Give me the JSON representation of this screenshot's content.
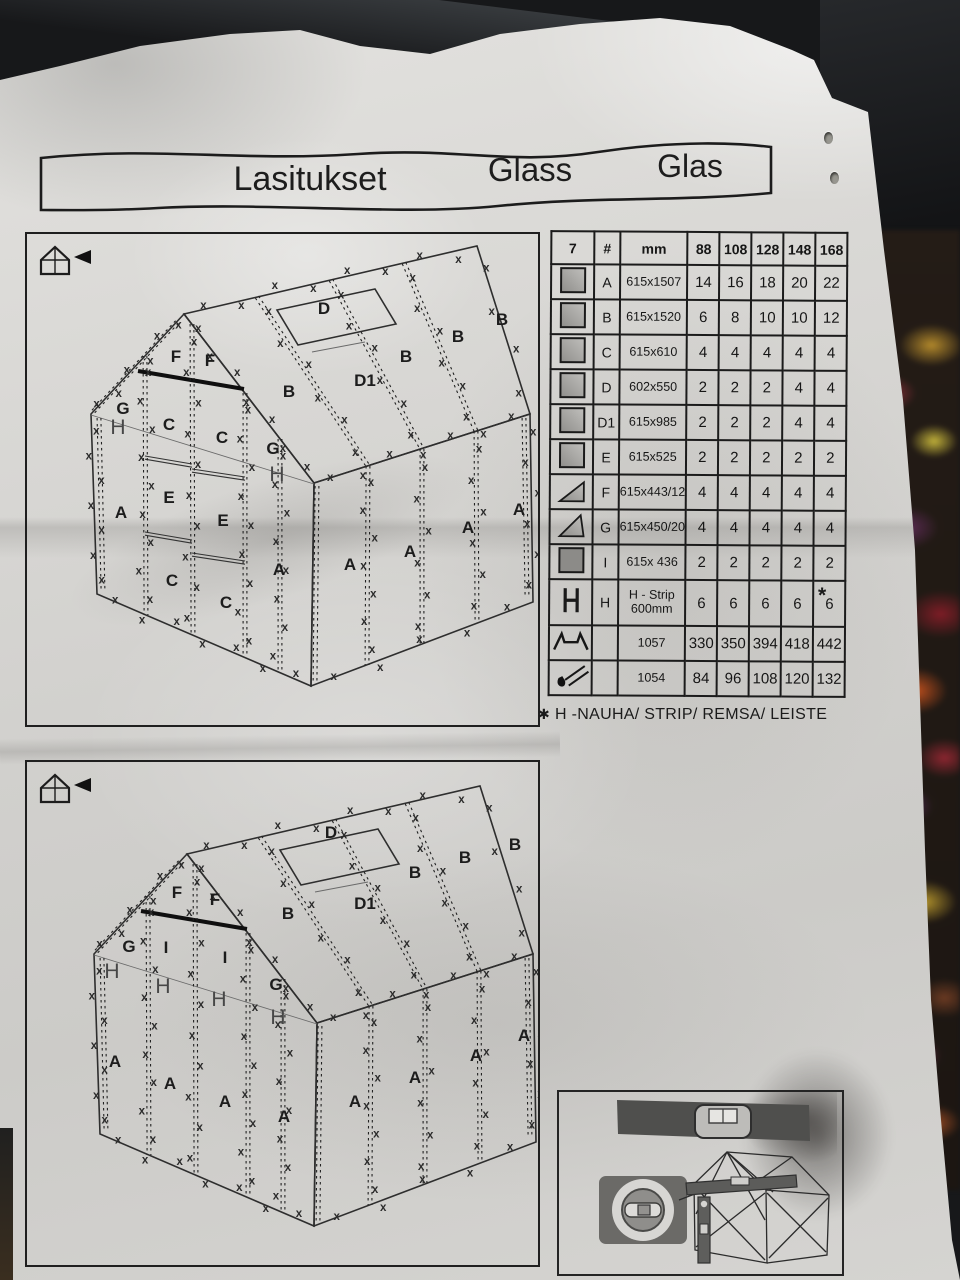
{
  "title_banner": {
    "fi": "Lasitukset",
    "en": "Glass",
    "de": "Glas"
  },
  "table": {
    "figure_number": "7",
    "header": {
      "hash": "#",
      "mm": "mm",
      "sizes": [
        "88",
        "108",
        "128",
        "148",
        "168"
      ]
    },
    "rows": [
      {
        "icon": "glass-panel-icon",
        "label": "A",
        "mm": "615x1507",
        "qty": [
          "14",
          "16",
          "18",
          "20",
          "22"
        ]
      },
      {
        "icon": "glass-panel-icon",
        "label": "B",
        "mm": "615x1520",
        "qty": [
          "6",
          "8",
          "10",
          "10",
          "12"
        ]
      },
      {
        "icon": "glass-panel-icon",
        "label": "C",
        "mm": "615x610",
        "qty": [
          "4",
          "4",
          "4",
          "4",
          "4"
        ]
      },
      {
        "icon": "glass-panel-icon",
        "label": "D",
        "mm": "602x550",
        "qty": [
          "2",
          "2",
          "2",
          "4",
          "4"
        ]
      },
      {
        "icon": "glass-panel-icon",
        "label": "D1",
        "mm": "615x985",
        "qty": [
          "2",
          "2",
          "2",
          "4",
          "4"
        ]
      },
      {
        "icon": "glass-panel-icon",
        "label": "E",
        "mm": "615x525",
        "qty": [
          "2",
          "2",
          "2",
          "2",
          "2"
        ]
      },
      {
        "icon": "gable-triangle-f-icon",
        "label": "F",
        "mm": "615x443/12",
        "qty": [
          "4",
          "4",
          "4",
          "4",
          "4"
        ]
      },
      {
        "icon": "gable-triangle-g-icon",
        "label": "G",
        "mm": "615x450/20",
        "qty": [
          "4",
          "4",
          "4",
          "4",
          "4"
        ]
      },
      {
        "icon": "dark-panel-icon",
        "label": "I",
        "mm": "615x 436",
        "qty": [
          "2",
          "2",
          "2",
          "2",
          "2"
        ]
      },
      {
        "icon": "h-profile-icon",
        "label": "H",
        "mm": "H - Strip",
        "mm2": "600mm",
        "qty": [
          "6",
          "6",
          "6",
          "6",
          "6"
        ],
        "tall": true
      },
      {
        "icon": "w-clip-icon",
        "label": "",
        "mm": "1057",
        "qty": [
          "330",
          "350",
          "394",
          "418",
          "442"
        ]
      },
      {
        "icon": "spring-clip-icon",
        "label": "",
        "mm": "1054",
        "qty": [
          "84",
          "96",
          "108",
          "120",
          "132"
        ]
      }
    ],
    "h_row_star": "*"
  },
  "footnote": {
    "star": "✱",
    "text": "H -NAUHA/ STRIP/ REMSA/ LEISTE"
  },
  "figures": {
    "xmark": "x",
    "top": {
      "labels": [
        {
          "t": "D",
          "x": 297,
          "y": 80
        },
        {
          "t": "B",
          "x": 262,
          "y": 163
        },
        {
          "t": "D1",
          "x": 338,
          "y": 152
        },
        {
          "t": "B",
          "x": 379,
          "y": 128
        },
        {
          "t": "B",
          "x": 431,
          "y": 108
        },
        {
          "t": "B",
          "x": 475,
          "y": 91
        },
        {
          "t": "F",
          "x": 149,
          "y": 128
        },
        {
          "t": "F",
          "x": 183,
          "y": 132
        },
        {
          "t": "G",
          "x": 96,
          "y": 180
        },
        {
          "t": "H",
          "x": 91,
          "y": 200
        },
        {
          "t": "C",
          "x": 142,
          "y": 196
        },
        {
          "t": "C",
          "x": 195,
          "y": 209
        },
        {
          "t": "G",
          "x": 246,
          "y": 220
        },
        {
          "t": "H",
          "x": 250,
          "y": 247
        },
        {
          "t": "A",
          "x": 94,
          "y": 284
        },
        {
          "t": "E",
          "x": 142,
          "y": 269
        },
        {
          "t": "E",
          "x": 196,
          "y": 292
        },
        {
          "t": "C",
          "x": 145,
          "y": 352
        },
        {
          "t": "C",
          "x": 199,
          "y": 374
        },
        {
          "t": "A",
          "x": 252,
          "y": 341
        },
        {
          "t": "A",
          "x": 323,
          "y": 336
        },
        {
          "t": "A",
          "x": 383,
          "y": 323
        },
        {
          "t": "A",
          "x": 441,
          "y": 299
        },
        {
          "t": "A",
          "x": 492,
          "y": 281
        }
      ]
    },
    "bottom": {
      "labels": [
        {
          "t": "D",
          "x": 304,
          "y": 76
        },
        {
          "t": "B",
          "x": 261,
          "y": 157
        },
        {
          "t": "D1",
          "x": 338,
          "y": 147
        },
        {
          "t": "B",
          "x": 388,
          "y": 116
        },
        {
          "t": "B",
          "x": 438,
          "y": 101
        },
        {
          "t": "B",
          "x": 488,
          "y": 88
        },
        {
          "t": "F",
          "x": 150,
          "y": 136
        },
        {
          "t": "F",
          "x": 188,
          "y": 143
        },
        {
          "t": "G",
          "x": 102,
          "y": 190
        },
        {
          "t": "I",
          "x": 139,
          "y": 191
        },
        {
          "t": "I",
          "x": 198,
          "y": 201
        },
        {
          "t": "G",
          "x": 249,
          "y": 228
        },
        {
          "t": "H",
          "x": 85,
          "y": 216
        },
        {
          "t": "H",
          "x": 136,
          "y": 231
        },
        {
          "t": "H",
          "x": 192,
          "y": 244
        },
        {
          "t": "H",
          "x": 251,
          "y": 262
        },
        {
          "t": "A",
          "x": 88,
          "y": 305
        },
        {
          "t": "A",
          "x": 143,
          "y": 327
        },
        {
          "t": "A",
          "x": 198,
          "y": 345
        },
        {
          "t": "A",
          "x": 257,
          "y": 360
        },
        {
          "t": "A",
          "x": 328,
          "y": 345
        },
        {
          "t": "A",
          "x": 388,
          "y": 321
        },
        {
          "t": "A",
          "x": 449,
          "y": 299
        },
        {
          "t": "A",
          "x": 497,
          "y": 279
        }
      ]
    }
  }
}
